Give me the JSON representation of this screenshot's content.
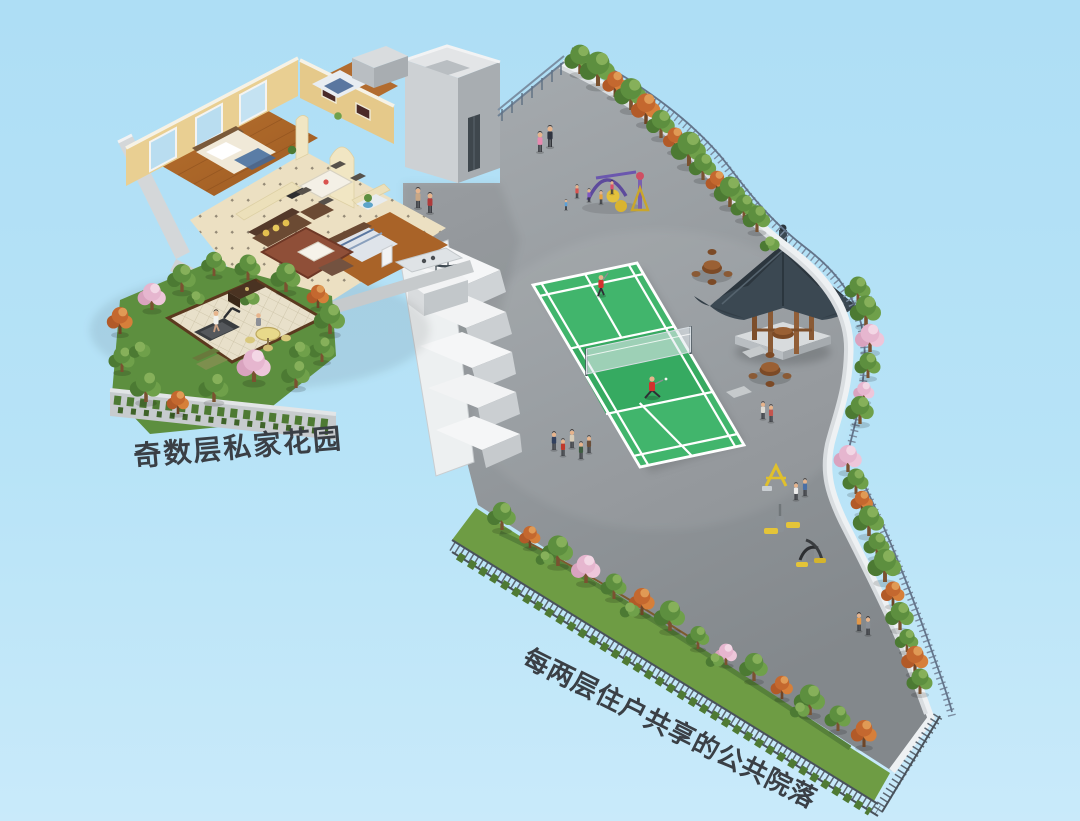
{
  "labels": {
    "private_garden": "奇数层私家花园",
    "shared_courtyard": "每两层住户共享的公共院落"
  },
  "scene": {
    "elements": [
      "apartment-interior-cutaway",
      "private-roof-garden",
      "shared-courtyard-deck",
      "badminton-court",
      "chinese-pavilion",
      "tea-table-sets",
      "children-playground",
      "outdoor-fitness-equipment",
      "perimeter-landscaping",
      "railings-and-fences",
      "elevator-core",
      "stepped-terrace-wall",
      "resident-figures"
    ]
  },
  "colors": {
    "background": "#b4e0f5",
    "deck_gray": "#94999d",
    "court_green": "#41b56c",
    "court_line": "#ffffff",
    "pavilion_roof": "#3b4852",
    "wood_brown": "#8a5a35",
    "foliage_green": "#5d8f3f",
    "blossom_pink": "#e6b6cf",
    "autumn_orange": "#c4682f",
    "wall_yellow": "#e7cf96",
    "label_text": "#3a3f45"
  }
}
